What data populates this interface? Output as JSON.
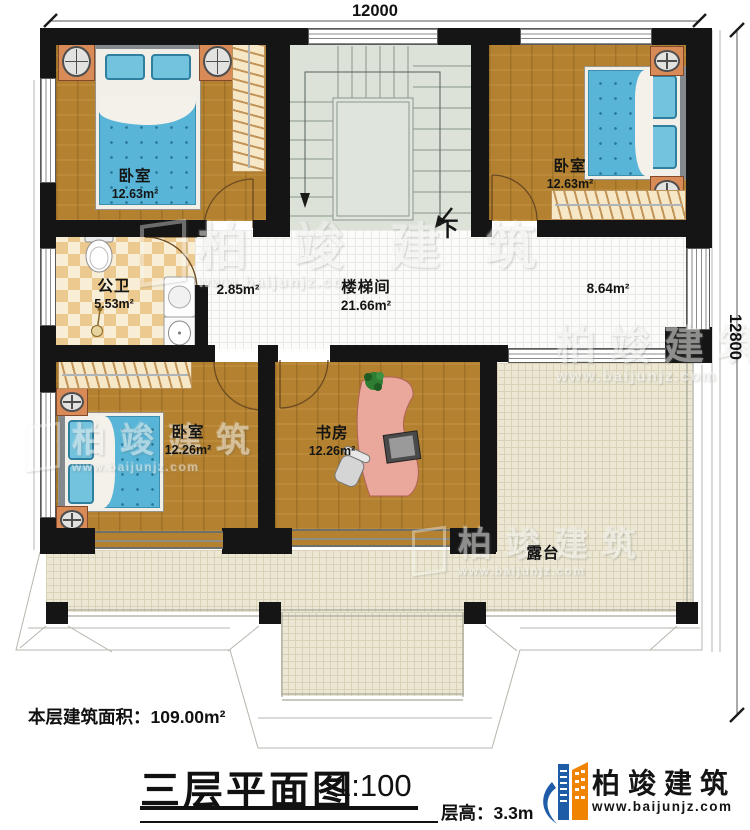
{
  "dimensions": {
    "top": "12000",
    "right": "12800"
  },
  "rooms": [
    {
      "name": "卧室",
      "area": "12.63m²"
    },
    {
      "name": "卧室",
      "area": "12.63m²"
    },
    {
      "name": "公卫",
      "area": "5.53m²"
    },
    {
      "name": "楼梯间",
      "area": "21.66m²"
    },
    {
      "name": "卧室",
      "area": "12.26m²"
    },
    {
      "name": "书房",
      "area": "12.26m²"
    },
    {
      "name": "露台",
      "area": ""
    }
  ],
  "annotations": {
    "vestibule_area": "2.85m²",
    "landing_area": "8.64m²",
    "stairs_down": "下"
  },
  "footer": {
    "floor_area": "本层建筑面积：109.00m²",
    "title": "三层平面图",
    "scale": "1:100",
    "floor_height": "层高：3.3m"
  },
  "brand": {
    "name": "柏竣建筑",
    "url": "www.baijunjz.com"
  },
  "watermark": {
    "name": "柏竣建筑",
    "url": "www.baijunjz.com"
  },
  "colors": {
    "wall": "#151515",
    "wood": "#b3812f",
    "stair": "#dce2d8",
    "terrace": "#ece7d3",
    "accent_orange": "#f08300",
    "accent_blue": "#1e5ca8"
  }
}
